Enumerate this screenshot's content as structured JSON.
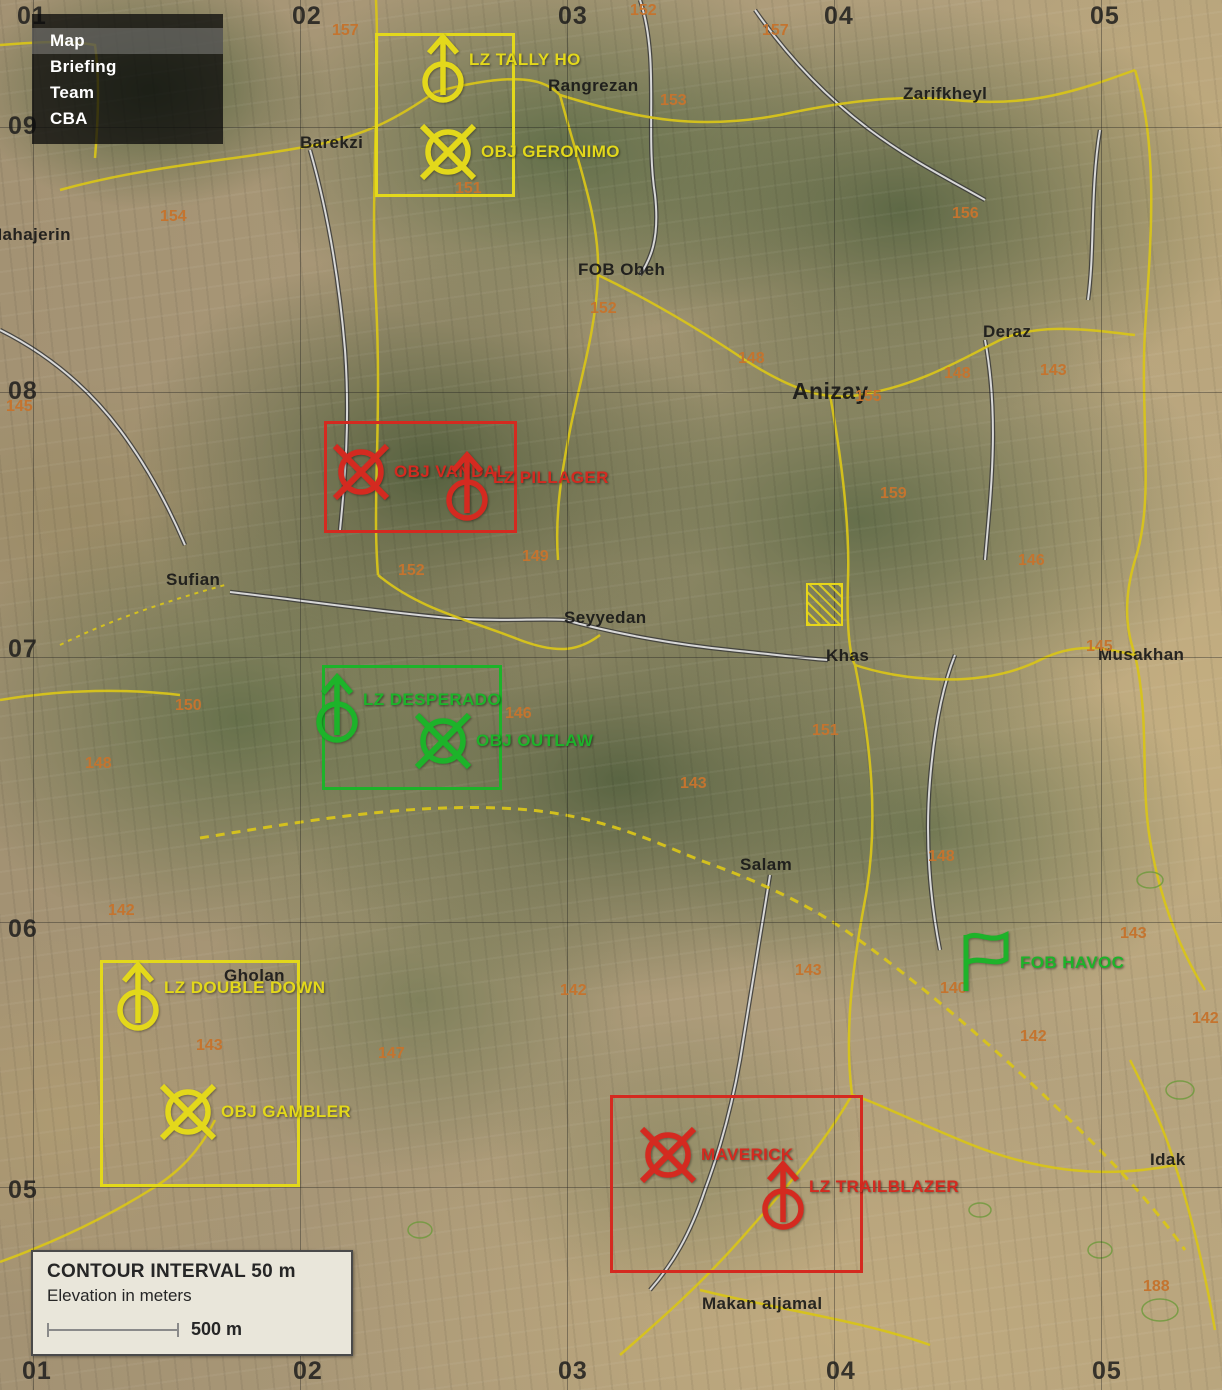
{
  "menu": {
    "items": [
      {
        "label": "Map",
        "active": true
      },
      {
        "label": "Briefing",
        "active": false
      },
      {
        "label": "Team",
        "active": false
      },
      {
        "label": "CBA",
        "active": false
      }
    ]
  },
  "legend": {
    "line1": "CONTOUR INTERVAL 50 m",
    "line2": "Elevation in meters",
    "scale_label": "500 m"
  },
  "colors": {
    "yellow": "#e3d81b",
    "red": "#d42a20",
    "green": "#1db32a",
    "elevation": "#c4742f"
  },
  "grid": {
    "v_lines": [
      33,
      300,
      567,
      834,
      1101
    ],
    "h_lines": [
      127,
      392,
      657,
      922,
      1187
    ],
    "top": [
      {
        "label": "01",
        "x": 17
      },
      {
        "label": "02",
        "x": 292
      },
      {
        "label": "03",
        "x": 558
      },
      {
        "label": "04",
        "x": 824
      },
      {
        "label": "05",
        "x": 1090
      }
    ],
    "left": [
      {
        "label": "09",
        "y": 112
      },
      {
        "label": "08",
        "y": 377
      },
      {
        "label": "07",
        "y": 635
      },
      {
        "label": "06",
        "y": 915
      },
      {
        "label": "05",
        "y": 1176
      }
    ],
    "bottom": [
      {
        "label": "01",
        "x": 22
      },
      {
        "label": "02",
        "x": 293
      },
      {
        "label": "03",
        "x": 558
      },
      {
        "label": "04",
        "x": 826
      },
      {
        "label": "05",
        "x": 1092
      }
    ]
  },
  "zones": [
    {
      "name": "tally-ho",
      "color": "yellow",
      "x": 375,
      "y": 33,
      "w": 140,
      "h": 164
    },
    {
      "name": "vandal",
      "color": "red",
      "x": 324,
      "y": 421,
      "w": 193,
      "h": 112
    },
    {
      "name": "desperado",
      "color": "green",
      "x": 322,
      "y": 665,
      "w": 180,
      "h": 125
    },
    {
      "name": "gambler",
      "color": "yellow",
      "x": 100,
      "y": 960,
      "w": 200,
      "h": 227
    },
    {
      "name": "maverick",
      "color": "red",
      "x": 610,
      "y": 1095,
      "w": 253,
      "h": 178
    }
  ],
  "markers": [
    {
      "type": "lz",
      "label": "LZ TALLY HO",
      "color": "yellow",
      "x": 443,
      "y": 82
    },
    {
      "type": "obj",
      "label": "OBJ GERONIMO",
      "color": "yellow",
      "x": 448,
      "y": 152
    },
    {
      "type": "obj",
      "label": "OBJ VANDAL",
      "color": "red",
      "x": 361,
      "y": 472
    },
    {
      "type": "lz",
      "label": "LZ PILLAGER",
      "color": "red",
      "x": 467,
      "y": 500
    },
    {
      "type": "lz",
      "label": "LZ DESPERADO",
      "color": "green",
      "x": 337,
      "y": 722
    },
    {
      "type": "obj",
      "label": "OBJ OUTLAW",
      "color": "green",
      "x": 443,
      "y": 741
    },
    {
      "type": "lz",
      "label": "LZ DOUBLE DOWN",
      "color": "yellow",
      "x": 138,
      "y": 1010
    },
    {
      "type": "obj",
      "label": "OBJ GAMBLER",
      "color": "yellow",
      "x": 188,
      "y": 1112
    },
    {
      "type": "flag",
      "label": "FOB HAVOC",
      "color": "green",
      "x": 968,
      "y": 965
    },
    {
      "type": "obj",
      "label": "MAVERICK",
      "color": "red",
      "x": 668,
      "y": 1155
    },
    {
      "type": "lz",
      "label": "LZ TRAILBLAZER",
      "color": "red",
      "x": 783,
      "y": 1209
    }
  ],
  "compound_marker": {
    "x": 806,
    "y": 583,
    "w": 37,
    "h": 43
  },
  "places": [
    {
      "name": "Mahajerin",
      "x": -12,
      "y": 225
    },
    {
      "name": "Barekzi",
      "x": 300,
      "y": 133
    },
    {
      "name": "Rangrezan",
      "x": 548,
      "y": 76
    },
    {
      "name": "Zarifkheyl",
      "x": 903,
      "y": 84
    },
    {
      "name": "FOB Obeh",
      "x": 578,
      "y": 260
    },
    {
      "name": "Anizay",
      "x": 792,
      "y": 378,
      "size": "lg"
    },
    {
      "name": "Deraz",
      "x": 983,
      "y": 322
    },
    {
      "name": "Sufian",
      "x": 166,
      "y": 570
    },
    {
      "name": "Seyyedan",
      "x": 564,
      "y": 608
    },
    {
      "name": "Khas",
      "x": 826,
      "y": 646
    },
    {
      "name": "Musakhan",
      "x": 1098,
      "y": 645
    },
    {
      "name": "Salam",
      "x": 740,
      "y": 855
    },
    {
      "name": "Gholan",
      "x": 224,
      "y": 966
    },
    {
      "name": "Idak",
      "x": 1150,
      "y": 1150
    },
    {
      "name": "Makan aljamal",
      "x": 702,
      "y": 1294
    }
  ],
  "elevations": [
    {
      "v": "157",
      "x": 332,
      "y": 22
    },
    {
      "v": "152",
      "x": 630,
      "y": 2
    },
    {
      "v": "157",
      "x": 762,
      "y": 22
    },
    {
      "v": "153",
      "x": 660,
      "y": 92
    },
    {
      "v": "156",
      "x": 952,
      "y": 205
    },
    {
      "v": "154",
      "x": 160,
      "y": 208
    },
    {
      "v": "151",
      "x": 455,
      "y": 180
    },
    {
      "v": "152",
      "x": 590,
      "y": 300
    },
    {
      "v": "148",
      "x": 738,
      "y": 350
    },
    {
      "v": "148",
      "x": 944,
      "y": 365
    },
    {
      "v": "143",
      "x": 1040,
      "y": 362
    },
    {
      "v": "155",
      "x": 855,
      "y": 388
    },
    {
      "v": "145",
      "x": 6,
      "y": 398
    },
    {
      "v": "159",
      "x": 880,
      "y": 485
    },
    {
      "v": "152",
      "x": 398,
      "y": 562
    },
    {
      "v": "149",
      "x": 522,
      "y": 548
    },
    {
      "v": "146",
      "x": 1018,
      "y": 552
    },
    {
      "v": "145",
      "x": 1086,
      "y": 638
    },
    {
      "v": "150",
      "x": 175,
      "y": 697
    },
    {
      "v": "148",
      "x": 85,
      "y": 755
    },
    {
      "v": "146",
      "x": 505,
      "y": 705
    },
    {
      "v": "151",
      "x": 812,
      "y": 722
    },
    {
      "v": "143",
      "x": 680,
      "y": 775
    },
    {
      "v": "148",
      "x": 928,
      "y": 848
    },
    {
      "v": "142",
      "x": 108,
      "y": 902
    },
    {
      "v": "143",
      "x": 1120,
      "y": 925
    },
    {
      "v": "143",
      "x": 795,
      "y": 962
    },
    {
      "v": "140",
      "x": 940,
      "y": 980
    },
    {
      "v": "142",
      "x": 560,
      "y": 982
    },
    {
      "v": "142",
      "x": 1020,
      "y": 1028
    },
    {
      "v": "142",
      "x": 1192,
      "y": 1010
    },
    {
      "v": "143",
      "x": 196,
      "y": 1037
    },
    {
      "v": "147",
      "x": 378,
      "y": 1045
    },
    {
      "v": "188",
      "x": 1143,
      "y": 1278
    }
  ]
}
